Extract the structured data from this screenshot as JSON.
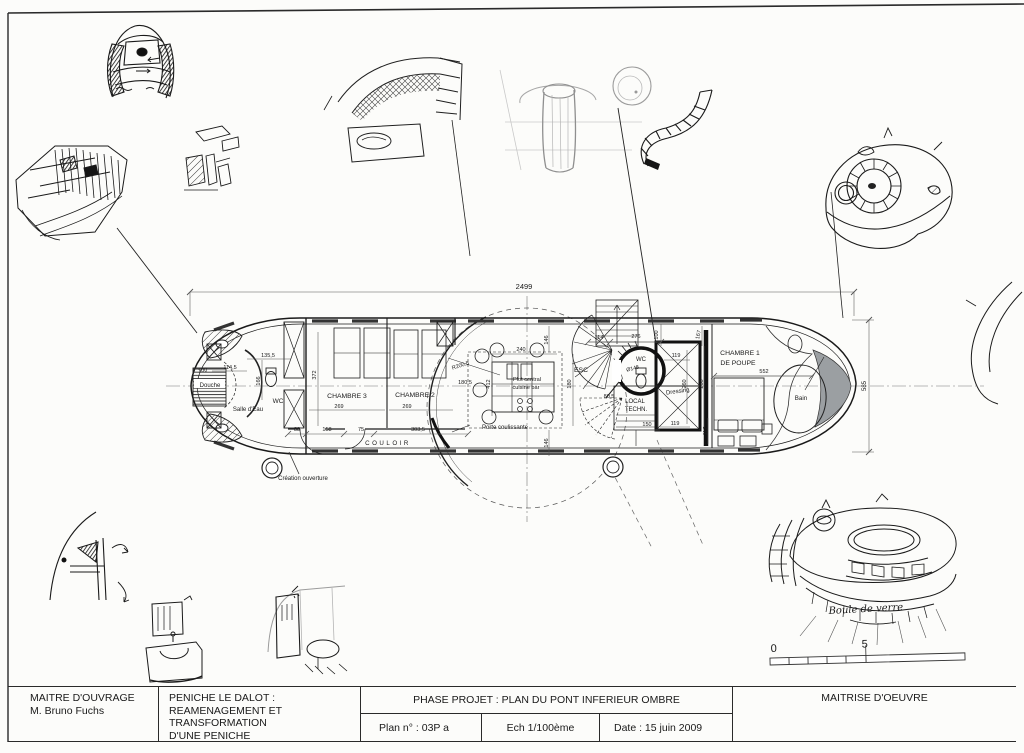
{
  "title_block": {
    "client_label": "MAITRE D'OUVRAGE",
    "client_name": "M. Bruno Fuchs",
    "project_line1": "PENICHE LE DALOT :",
    "project_line2": "REAMENAGEMENT ET TRANSFORMATION",
    "project_line3": "D'UNE PENICHE",
    "phase": "PHASE PROJET : PLAN DU PONT INFERIEUR OMBRE",
    "plan_no": "Plan n° :  03P a",
    "scale": "Ech 1/100ème",
    "date": "Date : 15 juin 2009",
    "moe": "MAITRISE D'OEUVRE"
  },
  "plan": {
    "labels": {
      "douche": "Douche",
      "salle_eau": "Salle d'Eau",
      "wc_bow": "WC",
      "chambre3": "CHAMBRE 3",
      "chambre2": "CHAMBRE 2",
      "couloir": "COULOIR",
      "creation": "Création ouverture",
      "porte": "Porte coulissante",
      "plot1": "Plot central",
      "plot2": "cuisine bar",
      "esc": "ESC",
      "wc_pod": "WC",
      "dressing": "Dressing",
      "local1": "LOCAL",
      "local2": "TECHN.",
      "chambre1_l1": "CHAMBRE 1",
      "chambre1_l2": "DE POUPE",
      "bain": "Bain"
    },
    "dims": {
      "overall": "2499",
      "beam": "585",
      "d100a": "100",
      "d114_5": "114,5",
      "d135_5": "135,5",
      "d166": "166",
      "d372": "372",
      "d269a": "269",
      "d269b": "269",
      "d88": "88",
      "d158": "158",
      "d75": "75",
      "d303_5": "303,5",
      "r200_5": "R200,5",
      "d180_5": "180,5",
      "d240": "240",
      "d146a": "146",
      "d146b": "146",
      "d412": "412",
      "d180": "180",
      "d114": "114",
      "d276": "276",
      "d100b": "100",
      "d167": "167",
      "dia148": "Ø148",
      "d119a": "119",
      "d119b": "119",
      "d80_5": "80,5",
      "d150": "150",
      "d260": "260",
      "d268": "268",
      "d117": "117",
      "d552": "552"
    }
  },
  "scalebar": {
    "zero": "0",
    "five": "5"
  },
  "annotation": {
    "handwritten": "Boule de verre"
  }
}
